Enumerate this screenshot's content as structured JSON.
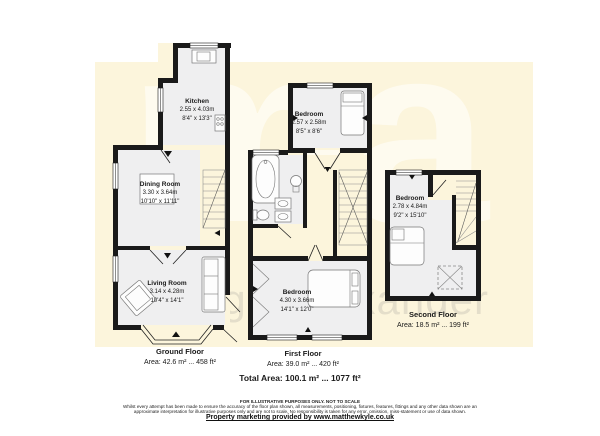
{
  "watermark": {
    "logo_text": "ma",
    "brand_text": "morganalexander"
  },
  "floors": {
    "ground": {
      "name": "Ground Floor",
      "area": "Area: 42.6 m² ... 458 ft²",
      "rooms": {
        "kitchen": {
          "name": "Kitchen",
          "metric": "2.55 x 4.03m",
          "imperial": "8'4\" x 13'3\""
        },
        "dining": {
          "name": "Dining Room",
          "metric": "3.30 x 3.64m",
          "imperial": "10'10\" x 11'11\""
        },
        "living": {
          "name": "Living Room",
          "metric": "3.14 x 4.28m",
          "imperial": "10'4\" x 14'1\""
        }
      }
    },
    "first": {
      "name": "First Floor",
      "area": "Area: 39.0 m² ... 420 ft²",
      "rooms": {
        "bedroom_top": {
          "name": "Bedroom",
          "metric": "2.57 x 2.58m",
          "imperial": "8'5\" x 8'6\""
        },
        "bedroom_main": {
          "name": "Bedroom",
          "metric": "4.30 x 3.66m",
          "imperial": "14'1\" x 12'0\""
        }
      }
    },
    "second": {
      "name": "Second Floor",
      "area": "Area: 18.5 m² ... 199 ft²",
      "rooms": {
        "bedroom": {
          "name": "Bedroom",
          "metric": "2.78 x 4.84m",
          "imperial": "9'2\" x 15'10\""
        }
      }
    }
  },
  "totals": {
    "total_area": "Total Area: 100.1 m² ... 1077 ft²"
  },
  "footer": {
    "notice": "FOR ILLUSTRATIVE PURPOSES ONLY. NOT TO SCALE",
    "disclaimer_line1": "Whilst every attempt has been made to ensure the accuracy of the floor plan shown, all measurements, positioning, fixtures, features, fittings and any other data shown are an",
    "disclaimer_line2": "approximate interpretation for illustrative purposes only and are not to scale. No responsibility is taken for any error, omission, miss-statement or use of data shown.",
    "credit": "Property marketing provided by www.matthewkyle.co.uk"
  },
  "colors": {
    "paper": "#ffffff",
    "plan_background": "#fcf5dc",
    "wall": "#1a1a1a",
    "room_fill": "#efeff0"
  }
}
